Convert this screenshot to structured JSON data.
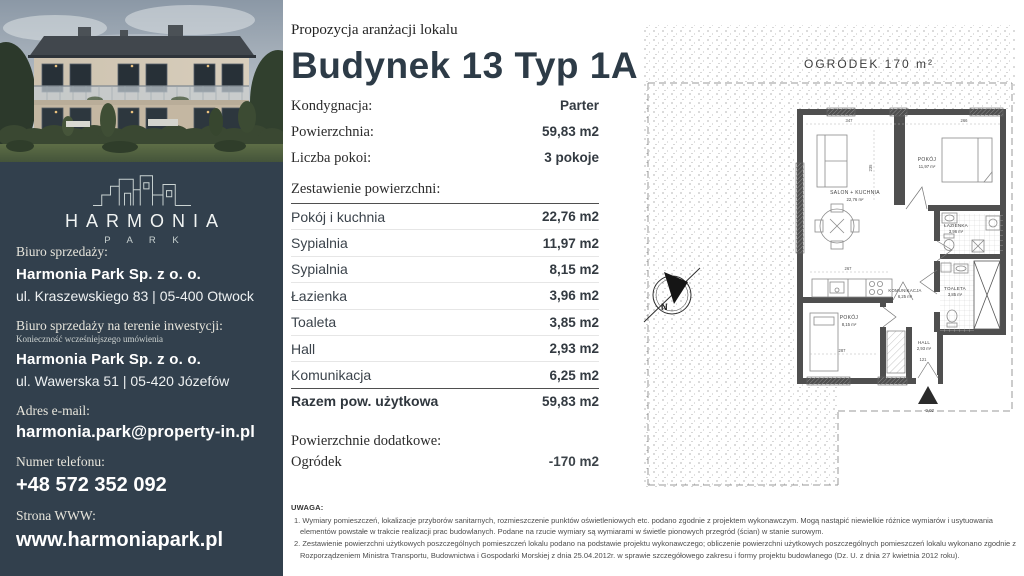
{
  "sidebar": {
    "brand": "HARMONIA",
    "brand_sub": "P A R K",
    "sales_office_label": "Biuro sprzedaży:",
    "sales_office_name": "Harmonia Park Sp. z o. o.",
    "sales_office_address": "ul. Kraszewskiego 83 | 05-400 Otwock",
    "site_office_label": "Biuro sprzedaży na terenie inwestycji:",
    "site_office_note": "Konieczność wcześniejszego umówienia",
    "site_office_name": "Harmonia Park Sp. z o. o.",
    "site_office_address": "ul. Wawerska 51 | 05-420 Józefów",
    "email_label": "Adres e-mail:",
    "email": "harmonia.park@property-in.pl",
    "phone_label": "Numer telefonu:",
    "phone": "+48 572 352 092",
    "www_label": "Strona WWW:",
    "www": "www.harmoniapark.pl"
  },
  "main": {
    "eyebrow": "Propozycja aranżacji lokalu",
    "title": "Budynek 13 Typ 1A",
    "specs": [
      {
        "label": "Kondygnacja:",
        "value": "Parter"
      },
      {
        "label": "Powierzchnia:",
        "value": "59,83 m2"
      },
      {
        "label": "Liczba pokoi:",
        "value": "3 pokoje"
      }
    ],
    "breakdown_label": "Zestawienie powierzchni:",
    "rows": [
      {
        "label": "Pokój i kuchnia",
        "value": "22,76 m2"
      },
      {
        "label": "Sypialnia",
        "value": "11,97 m2"
      },
      {
        "label": "Sypialnia",
        "value": "8,15 m2"
      },
      {
        "label": "Łazienka",
        "value": "3,96 m2"
      },
      {
        "label": "Toaleta",
        "value": "3,85 m2"
      },
      {
        "label": "Hall",
        "value": "2,93 m2"
      },
      {
        "label": "Komunikacja",
        "value": "6,25 m2"
      }
    ],
    "total": {
      "label": "Razem pow. użytkowa",
      "value": "59,83 m2"
    },
    "additional_label": "Powierzchnie dodatkowe:",
    "additional_row": {
      "label": "Ogródek",
      "value": "-170 m2"
    }
  },
  "floorplan": {
    "garden_label": "OGRÓDEK 170 m²",
    "compass": "N",
    "entry_level": "-0,02",
    "rooms": {
      "salon": {
        "name": "SALON + KUCHNIA",
        "area": "22,76 m²"
      },
      "bedroom1": {
        "name": "POKÓJ",
        "area": "11,97 m²"
      },
      "bedroom2": {
        "name": "POKÓJ",
        "area": "8,15 m²"
      },
      "bathroom": {
        "name": "ŁAZIENKA",
        "area": "3,96 m²"
      },
      "toilet": {
        "name": "TOALETA",
        "area": "3,85 m²"
      },
      "hall": {
        "name": "HALL",
        "area": "2,93 m²"
      },
      "corridor": {
        "name": "KOMUNIKACJA",
        "area": "6,25 m²"
      }
    },
    "dims": {
      "a": "347",
      "b": "42",
      "c": "266",
      "d": "235",
      "e": "267",
      "f": "287",
      "g": "121"
    }
  },
  "notes": {
    "heading": "UWAGA:",
    "items": [
      "1. Wymiary pomieszczeń, lokalizacje przyborów sanitarnych, rozmieszczenie punktów oświetleniowych etc. podano zgodnie z projektem wykonawczym. Mogą nastąpić niewielkie różnice wymiarów i usytuowania elementów powstałe w trakcie realizacji prac budowlanych. Podane na rzucie wymiary są wymiarami w świetle pionowych przegród (ścian) w stanie surowym.",
      "2. Zestawienie powierzchni użytkowych poszczególnych pomieszczeń lokalu podano na podstawie projektu wykonawczego; obliczenie powierzchni użytkowych poszczególnych pomieszczeń lokalu wykonano zgodnie z Rozporządzeniem Ministra Transportu, Budownictwa i Gospodarki Morskiej z dnia 25.04.2012r. w sprawie szczegółowego zakresu i formy projektu budowlanego (Dz. U. z dnia 27 kwietnia 2012 roku)."
    ]
  },
  "colors": {
    "sidebar_bg": "#32404d",
    "title_text": "#2d3b47",
    "wall": "#4f4f4f"
  }
}
